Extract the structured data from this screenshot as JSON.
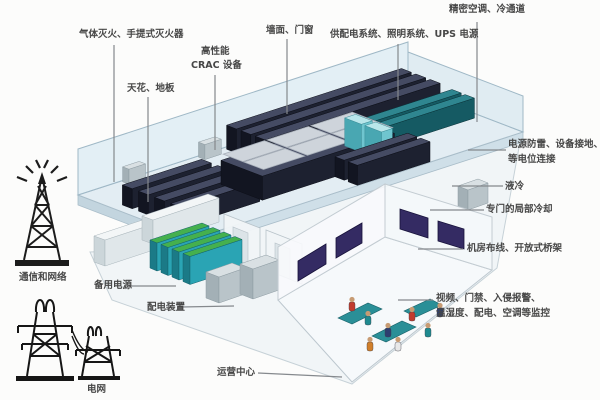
{
  "diagram": {
    "title_note": "data-center machine-room composition diagram",
    "labels": {
      "fire_extinguishing": "气体灭火、手提式灭火器",
      "ceiling_floor": "天花、地板",
      "crac_line1": "高性能",
      "crac_line2": "CRAC 设备",
      "wall_doors": "墙面、门窗",
      "power_supply": "供配电系统、照明系统、UPS 电源",
      "precision_ac": "精密空调、冷通道",
      "grounding_line1": "电源防雷、设备接地、",
      "grounding_line2": "等电位连接",
      "liquid_cooling": "液冷",
      "local_cooling": "专门的局部冷却",
      "cabling": "机房布线、开放式桥架",
      "monitoring_line1": "视频、门禁、入侵报警、",
      "monitoring_line2": "温湿度、配电、空调等监控",
      "operations_center": "运营中心",
      "distribution_equipment": "配电装置",
      "backup_power": "备用电源",
      "comm_network": "通信和网络",
      "power_grid": "电网"
    },
    "icons": {
      "comm_tower": "radio-tower-icon",
      "power_grid": "transmission-pylon-icon"
    },
    "colors": {
      "rack_dark": "#1d2130",
      "rack_teal": "#155a63",
      "battery_teal": "#2aa4b4",
      "battery_green_top": "#45b04e",
      "floor_slab": "#e3edf3",
      "glass_wall": "#cde4f0",
      "monitor_screen": "#342b63",
      "label_text": "#474747"
    }
  }
}
